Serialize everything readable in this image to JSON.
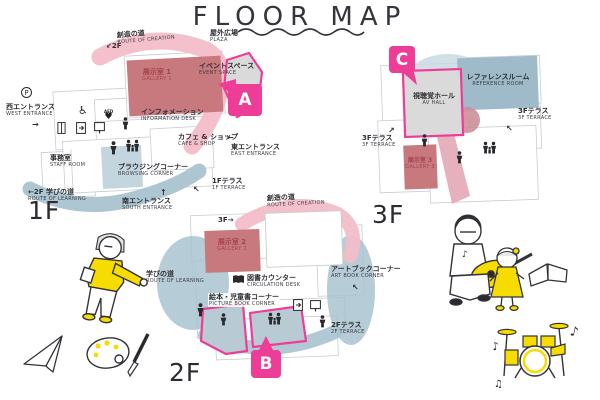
{
  "title": "FLOOR MAP",
  "colors": {
    "accent_pink": "#EE3D96",
    "route_pink": "#F3BDC8",
    "gallery_rose": "#C7797D",
    "gallery_text": "#A6434B",
    "route_blue": "#A9C3D0",
    "room_blue": "#9FBAC8",
    "room_gray": "#DADADA",
    "highlight_yellow": "#F6DC00",
    "ink": "#32323A"
  },
  "markers": {
    "a": "A",
    "b": "B",
    "c": "C"
  },
  "f1": {
    "floor": "1F",
    "route_creation_jp": "創造の道",
    "route_creation_en": "ROUTE OF CREATION",
    "stairs_nw": "↙2F",
    "plaza_jp": "屋外広場",
    "plaza_en": "PLAZA",
    "event_jp": "イベントスペース",
    "event_en": "EVENT SPACE",
    "gallery_jp": "展示室 1",
    "gallery_en": "GALLERY 1",
    "west_jp": "西エントランス",
    "west_en": "WEST ENTRANCE",
    "west_arrow": "→",
    "parking": "P",
    "aed": "AED",
    "heart": "♥",
    "wheelchair": "♿",
    "info_jp": "インフォメーション",
    "info_en": "INFORMATION DESK",
    "cafe_jp": "カフェ & ショップ",
    "cafe_en": "CAFE & SHOP",
    "east_jp": "東エントランス",
    "east_en": "EAST ENTRANCE",
    "east_arrow": "←",
    "staff_jp": "事務室",
    "staff_en": "STAFF ROOM",
    "browsing_jp": "ブラウジングコーナー",
    "browsing_en": "BROWSING CORNER",
    "learning_jp": "←2F 学びの道",
    "learning_en": "ROUTE OF LEARNING",
    "south_jp": "南エントランス",
    "south_en": "SOUTH ENTRANCE",
    "south_arrow": "↑",
    "terrace_jp": "1Fテラス",
    "terrace_en": "1F TERRACE",
    "terrace_arrow": "↖"
  },
  "f2": {
    "floor": "2F",
    "route_creation_jp": "創造の道",
    "route_creation_en": "ROUTE OF CREATION",
    "stairs_up": "3F→",
    "gallery_jp": "展示室 2",
    "gallery_en": "GALLERY 2",
    "circulation_jp": "図書カウンター",
    "circulation_en": "CIRCULATION DESK",
    "picture_jp": "絵本・児童書コーナー",
    "picture_en": "PICTURE BOOK CORNER",
    "artbook_jp": "アートブックコーナー",
    "artbook_en": "ART BOOK CORNER",
    "artbook_arrow": "↖",
    "terrace_jp": "2Fテラス",
    "terrace_en": "2F TERRACE",
    "learning_jp": "学びの道",
    "learning_en": "ROUTE OF LEARNING"
  },
  "f3": {
    "floor": "3F",
    "avhall_jp": "視聴覚ホール",
    "avhall_en": "AV HALL",
    "reference_jp": "レファレンスルーム",
    "reference_en": "REFERENCE ROOM",
    "terrace_right_jp": "3Fテラス",
    "terrace_right_en": "3F TERRACE",
    "terrace_right_arrow": "↖",
    "terrace_left_jp": "3Fテラス",
    "terrace_left_en": "3F TERRACE",
    "terrace_left_arrow": "↗",
    "gallery_jp": "展示室 3",
    "gallery_en": "GALLERY 3"
  },
  "notes": {
    "n1": "♪",
    "n2": "♪",
    "n3": "♪",
    "n4": "♫"
  }
}
